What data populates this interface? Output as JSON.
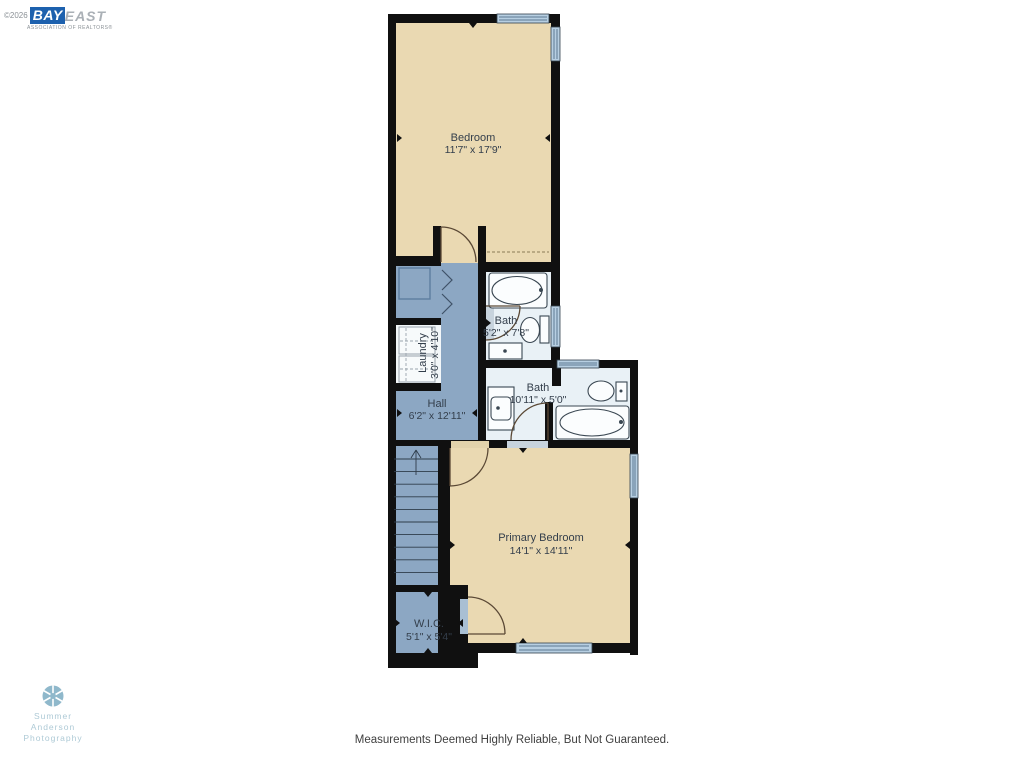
{
  "branding": {
    "copyright": "©2026",
    "bay": "BAY",
    "east": "EAST",
    "subtitle": "ASSOCIATION OF REALTORS®"
  },
  "plan": {
    "rooms": [
      {
        "name": "Bedroom",
        "dims": "11'7\" x 17'9\""
      },
      {
        "name": "Bath",
        "dims": "5'2\" x 7'8\""
      },
      {
        "name": "Laundry",
        "dims": "3'0\" x 4'10\""
      },
      {
        "name": "Hall",
        "dims": "6'2\" x 12'11\""
      },
      {
        "name": "Bath",
        "dims": "10'11\" x 5'0\""
      },
      {
        "name": "Primary Bedroom",
        "dims": "14'1\" x 14'11\""
      },
      {
        "name": "W.I.C.",
        "dims": "5'1\" x 5'4\""
      }
    ],
    "colors": {
      "wall": "#101010",
      "bedroom_fill": "#ead9b2",
      "hall_fill": "#8ca7c3",
      "bath_fill": "#e9f1f6",
      "window": "#b7cfe2",
      "label_text": "#333e4b"
    }
  },
  "photographer": {
    "line1": "Summer",
    "line2": "Anderson",
    "line3": "Photography"
  },
  "footer": {
    "disclaimer": "Measurements Deemed Highly Reliable, But Not Guaranteed."
  }
}
